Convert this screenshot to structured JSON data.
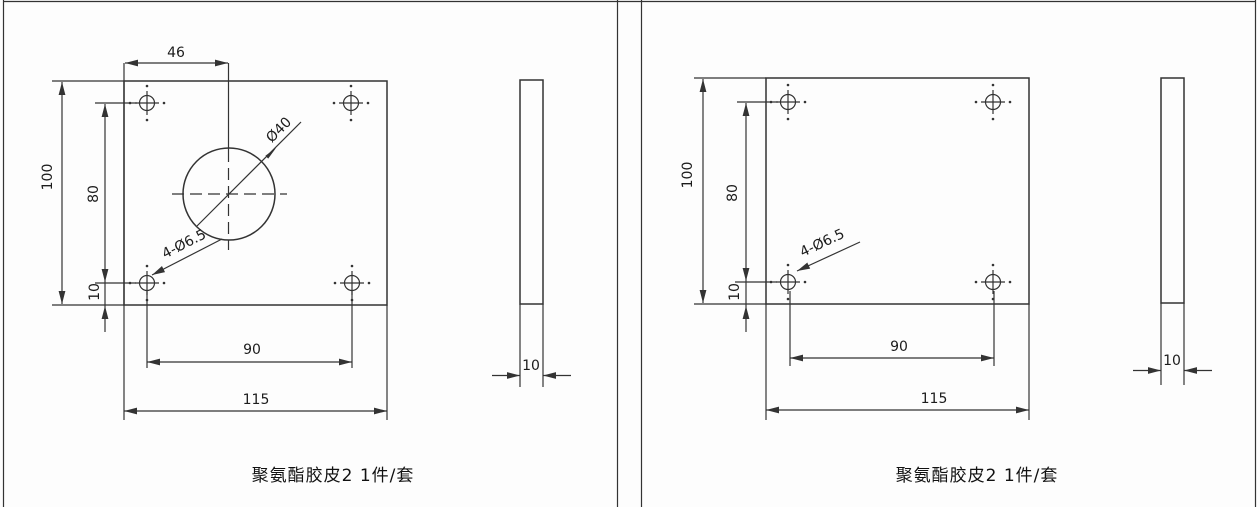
{
  "colors": {
    "line": "#333333",
    "text": "#1c1c1c",
    "background": "#fdfdfd"
  },
  "left_drawing": {
    "caption": "聚氨酯胶皮2 1件/套",
    "front_view": {
      "dim_hole_offset_x": "46",
      "dim_height": "100",
      "dim_hole_span_vertical": "80",
      "dim_hole_offset_bottom": "10",
      "dim_hole_span_horizontal": "90",
      "dim_width": "115",
      "center_hole_label": "Ø40",
      "corner_holes_label": "4-Ø6.5"
    },
    "side_view": {
      "dim_thickness": "10"
    }
  },
  "right_drawing": {
    "caption": "聚氨酯胶皮2 1件/套",
    "front_view": {
      "dim_height": "100",
      "dim_hole_span_vertical": "80",
      "dim_hole_offset_bottom": "10",
      "dim_hole_span_horizontal": "90",
      "dim_width": "115",
      "corner_holes_label": "4-Ø6.5"
    },
    "side_view": {
      "dim_thickness": "10"
    }
  }
}
